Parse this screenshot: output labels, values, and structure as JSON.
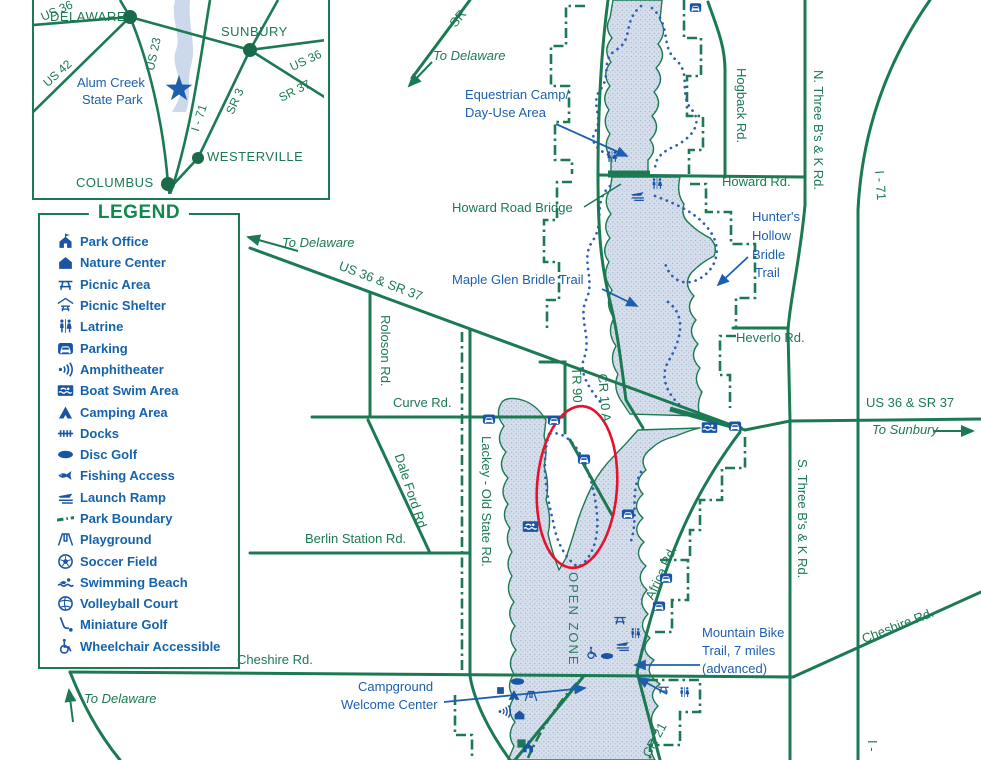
{
  "map_title": "Alum Creek State Park",
  "annotation": {
    "type": "ellipse-highlight",
    "color": "#e8112d"
  },
  "colors": {
    "road_green": "#1b7a52",
    "label_blue": "#1d5fae",
    "icon_blue": "#1a55a5",
    "teal": "#2e7c68",
    "lake_fill": "#d4dcec",
    "highlight_red": "#e8112d"
  },
  "inset": {
    "park_name_line1": "Alum Creek",
    "park_name_line2": "State Park",
    "cities": [
      "DELAWARE",
      "SUNBURY",
      "WESTERVILLE",
      "COLUMBUS"
    ],
    "roads": [
      "US 36",
      "US 42",
      "US 23",
      "I - 71",
      "SR 3",
      "SR 37",
      "US 36"
    ]
  },
  "legend": {
    "title": "LEGEND",
    "items": [
      {
        "icon": "park-office",
        "label": "Park Office"
      },
      {
        "icon": "nature-center",
        "label": "Nature Center"
      },
      {
        "icon": "picnic-area",
        "label": "Picnic Area"
      },
      {
        "icon": "picnic-shelter",
        "label": "Picnic Shelter"
      },
      {
        "icon": "latrine",
        "label": "Latrine"
      },
      {
        "icon": "parking",
        "label": "Parking"
      },
      {
        "icon": "amphitheater",
        "label": "Amphitheater"
      },
      {
        "icon": "boat-swim-area",
        "label": "Boat Swim Area"
      },
      {
        "icon": "camping-area",
        "label": "Camping Area"
      },
      {
        "icon": "docks",
        "label": "Docks"
      },
      {
        "icon": "disc-golf",
        "label": "Disc Golf"
      },
      {
        "icon": "fishing-access",
        "label": "Fishing Access"
      },
      {
        "icon": "launch-ramp",
        "label": "Launch Ramp"
      },
      {
        "icon": "park-boundary",
        "label": "Park Boundary"
      },
      {
        "icon": "playground",
        "label": "Playground"
      },
      {
        "icon": "soccer-field",
        "label": "Soccer Field"
      },
      {
        "icon": "swimming-beach",
        "label": "Swimming Beach"
      },
      {
        "icon": "volleyball-court",
        "label": "Volleyball Court"
      },
      {
        "icon": "miniature-golf",
        "label": "Miniature Golf"
      },
      {
        "icon": "wheelchair-accessible",
        "label": "Wheelchair Accessible"
      }
    ]
  },
  "map": {
    "labels": [
      {
        "name": "to-delaware-top",
        "text": "To Delaware",
        "x": 433,
        "y": 49,
        "c": "g",
        "i": 1
      },
      {
        "name": "to-delaware-mid",
        "text": "To Delaware",
        "x": 282,
        "y": 236,
        "c": "g",
        "i": 1
      },
      {
        "name": "to-delaware-bottom",
        "text": "To Delaware",
        "x": 84,
        "y": 692,
        "c": "g",
        "i": 1
      },
      {
        "name": "to-sunbury",
        "text": "To Sunbury",
        "x": 872,
        "y": 423,
        "c": "g",
        "i": 1
      },
      {
        "name": "us36-sr37-diagonal",
        "text": "US 36 & SR 37",
        "x": 342,
        "y": 259,
        "c": "g",
        "r": 21
      },
      {
        "name": "us36-sr37-east",
        "text": "US 36 & SR 37",
        "x": 866,
        "y": 396,
        "c": "g"
      },
      {
        "name": "howard-rd",
        "text": "Howard Rd.",
        "x": 722,
        "y": 175,
        "c": "g"
      },
      {
        "name": "howard-road-bridge",
        "text": "Howard Road Bridge",
        "x": 452,
        "y": 201,
        "c": "g"
      },
      {
        "name": "hogback-rd",
        "text": "Hogback Rd.",
        "x": 748,
        "y": 68,
        "c": "g",
        "r": 90
      },
      {
        "name": "n-three-bs-k-rd",
        "text": "N. Three B's & K Rd.",
        "x": 825,
        "y": 70,
        "c": "g",
        "r": 90
      },
      {
        "name": "i71-top",
        "text": "I - 71",
        "x": 886,
        "y": 170,
        "c": "g",
        "r": 86
      },
      {
        "name": "heverlo-rd",
        "text": "Heverlo Rd.",
        "x": 736,
        "y": 331,
        "c": "g"
      },
      {
        "name": "roloson-rd",
        "text": "Roloson Rd.",
        "x": 392,
        "y": 315,
        "c": "g",
        "r": 90
      },
      {
        "name": "curve-rd",
        "text": "Curve Rd.",
        "x": 393,
        "y": 396,
        "c": "g"
      },
      {
        "name": "dale-ford-rd",
        "text": "Dale Ford Rd.",
        "x": 405,
        "y": 452,
        "c": "g",
        "r": 72
      },
      {
        "name": "lackey-old-state-rd",
        "text": "Lackey - Old State Rd.",
        "x": 493,
        "y": 436,
        "c": "g",
        "r": 90
      },
      {
        "name": "tr-90",
        "text": "TR 90",
        "x": 583,
        "y": 367,
        "c": "g",
        "r": 88
      },
      {
        "name": "cr-10-a",
        "text": "CR 10 A",
        "x": 609,
        "y": 373,
        "c": "g",
        "r": 85
      },
      {
        "name": "berlin-station-rd",
        "text": "Berlin Station Rd.",
        "x": 305,
        "y": 532,
        "c": "g"
      },
      {
        "name": "cheshire-rd-west",
        "text": "Cheshire Rd.",
        "x": 237,
        "y": 653,
        "c": "g"
      },
      {
        "name": "cheshire-rd-east",
        "text": "Cheshire Rd.",
        "x": 860,
        "y": 633,
        "c": "g",
        "r": -21
      },
      {
        "name": "s-three-bs-k-rd",
        "text": "S. Three B's & K Rd.",
        "x": 809,
        "y": 459,
        "c": "g",
        "r": 90
      },
      {
        "name": "africa-rd",
        "text": "Africa Rd.",
        "x": 643,
        "y": 596,
        "c": "g",
        "r": -65
      },
      {
        "name": "cr-21",
        "text": "CR 21",
        "x": 640,
        "y": 753,
        "c": "g",
        "r": -62
      },
      {
        "name": "sr-partial",
        "text": "SR",
        "x": 447,
        "y": 21,
        "c": "g",
        "r": -50
      },
      {
        "name": "i71-bottom",
        "text": "I -",
        "x": 879,
        "y": 740,
        "c": "g",
        "r": 90
      },
      {
        "name": "open-zone",
        "text": "OPEN ZONE",
        "x": 580,
        "y": 572,
        "c": "t",
        "r": 90,
        "ls": 2
      },
      {
        "name": "equestrian-camp-line1",
        "text": "Equestrian Camp/",
        "x": 465,
        "y": 88,
        "c": "b"
      },
      {
        "name": "equestrian-camp-line2",
        "text": "Day-Use Area",
        "x": 465,
        "y": 106,
        "c": "b"
      },
      {
        "name": "maple-glen-bridle-trail",
        "text": "Maple Glen Bridle Trail",
        "x": 452,
        "y": 273,
        "c": "b"
      },
      {
        "name": "hunters-hollow-line1",
        "text": "Hunter's",
        "x": 752,
        "y": 210,
        "c": "b"
      },
      {
        "name": "hunters-hollow-line2",
        "text": "Hollow",
        "x": 752,
        "y": 229,
        "c": "b"
      },
      {
        "name": "hunters-hollow-line3",
        "text": "Bridle",
        "x": 752,
        "y": 248,
        "c": "b"
      },
      {
        "name": "hunters-hollow-line4",
        "text": "Trail",
        "x": 755,
        "y": 266,
        "c": "b"
      },
      {
        "name": "mountain-bike-line1",
        "text": "Mountain Bike",
        "x": 702,
        "y": 626,
        "c": "b"
      },
      {
        "name": "mountain-bike-line2",
        "text": "Trail, 7 miles",
        "x": 702,
        "y": 644,
        "c": "b"
      },
      {
        "name": "mountain-bike-line3",
        "text": "(advanced)",
        "x": 702,
        "y": 662,
        "c": "b"
      },
      {
        "name": "campground-line1",
        "text": "Campground",
        "x": 358,
        "y": 680,
        "c": "b"
      },
      {
        "name": "campground-line2",
        "text": "Welcome Center",
        "x": 341,
        "y": 698,
        "c": "b"
      },
      {
        "name": "inset-city-delaware",
        "text": "DELAWARE",
        "x": 50,
        "y": 10,
        "c": "g",
        "ls": 0.5
      },
      {
        "name": "inset-city-sunbury",
        "text": "SUNBURY",
        "x": 221,
        "y": 25,
        "c": "g",
        "ls": 0.5
      },
      {
        "name": "inset-city-westerville",
        "text": "WESTERVILLE",
        "x": 207,
        "y": 150,
        "c": "g",
        "ls": 0.5
      },
      {
        "name": "inset-city-columbus",
        "text": "COLUMBUS",
        "x": 76,
        "y": 176,
        "c": "g",
        "ls": 0.5
      },
      {
        "name": "inset-park-name-line1",
        "text": "Alum Creek",
        "x": 77,
        "y": 76,
        "c": "b"
      },
      {
        "name": "inset-park-name-line2",
        "text": "State Park",
        "x": 82,
        "y": 93,
        "c": "b"
      },
      {
        "name": "inset-road-us42",
        "text": "US 42",
        "x": 41,
        "y": 80,
        "c": "g",
        "r": -42,
        "s": 12
      },
      {
        "name": "inset-road-us23",
        "text": "US 23",
        "x": 144,
        "y": 69,
        "c": "g",
        "r": -78,
        "s": 12
      },
      {
        "name": "inset-road-i71",
        "text": "I - 71",
        "x": 189,
        "y": 129,
        "c": "g",
        "r": -72,
        "s": 12
      },
      {
        "name": "inset-road-sr3",
        "text": "SR 3",
        "x": 224,
        "y": 111,
        "c": "g",
        "r": -66,
        "s": 12
      },
      {
        "name": "inset-road-sr37",
        "text": "SR 37",
        "x": 277,
        "y": 93,
        "c": "g",
        "r": -27,
        "s": 12
      },
      {
        "name": "inset-road-us36-east",
        "text": "US 36",
        "x": 288,
        "y": 62,
        "c": "g",
        "r": -25,
        "s": 12
      },
      {
        "name": "inset-road-us36-northwest",
        "text": "US 36",
        "x": 39,
        "y": 12,
        "c": "g",
        "r": -24,
        "s": 12
      }
    ],
    "markers": [
      {
        "icon": "parking",
        "x": 695,
        "y": 7,
        "s": 13
      },
      {
        "icon": "parking",
        "x": 489,
        "y": 419,
        "s": 14
      },
      {
        "icon": "parking",
        "x": 554,
        "y": 420,
        "s": 14
      },
      {
        "icon": "parking",
        "x": 584,
        "y": 459,
        "s": 14
      },
      {
        "icon": "parking",
        "x": 628,
        "y": 514,
        "s": 14
      },
      {
        "icon": "parking",
        "x": 735,
        "y": 426,
        "s": 14
      },
      {
        "icon": "parking",
        "x": 666,
        "y": 578,
        "s": 14
      },
      {
        "icon": "parking",
        "x": 659,
        "y": 606,
        "s": 14
      },
      {
        "icon": "latrine",
        "x": 612,
        "y": 157,
        "s": 14
      },
      {
        "icon": "latrine",
        "x": 657,
        "y": 184,
        "s": 14
      },
      {
        "icon": "latrine",
        "x": 684,
        "y": 692,
        "s": 13
      },
      {
        "icon": "latrine",
        "x": 635,
        "y": 633,
        "s": 13
      },
      {
        "icon": "picnic-area",
        "x": 620,
        "y": 620,
        "s": 14
      },
      {
        "icon": "picnic-area",
        "x": 663,
        "y": 689,
        "s": 13
      },
      {
        "icon": "launch-ramp",
        "x": 637,
        "y": 195,
        "s": 15
      },
      {
        "icon": "launch-ramp",
        "x": 622,
        "y": 645,
        "s": 15
      },
      {
        "icon": "boat-swim-area",
        "x": 530,
        "y": 526,
        "s": 17
      },
      {
        "icon": "boat-swim-area",
        "x": 709,
        "y": 427,
        "s": 17
      },
      {
        "icon": "wheelchair-accessible",
        "x": 592,
        "y": 653,
        "s": 14
      },
      {
        "icon": "disc-golf",
        "x": 607,
        "y": 656,
        "s": 14
      },
      {
        "icon": "disc-golf",
        "x": 517,
        "y": 681,
        "s": 15
      },
      {
        "icon": "marker-square",
        "x": 500,
        "y": 686,
        "s": 9
      },
      {
        "icon": "camping-area",
        "x": 514,
        "y": 695,
        "s": 14
      },
      {
        "icon": "playground",
        "x": 531,
        "y": 696,
        "s": 14
      },
      {
        "icon": "amphitheater",
        "x": 504,
        "y": 711,
        "s": 15
      },
      {
        "icon": "nature-center",
        "x": 519,
        "y": 714,
        "s": 13
      },
      {
        "icon": "marker-square-green",
        "x": 521,
        "y": 741,
        "s": 11
      },
      {
        "icon": "park-office",
        "x": 528,
        "y": 747,
        "s": 14
      }
    ]
  }
}
